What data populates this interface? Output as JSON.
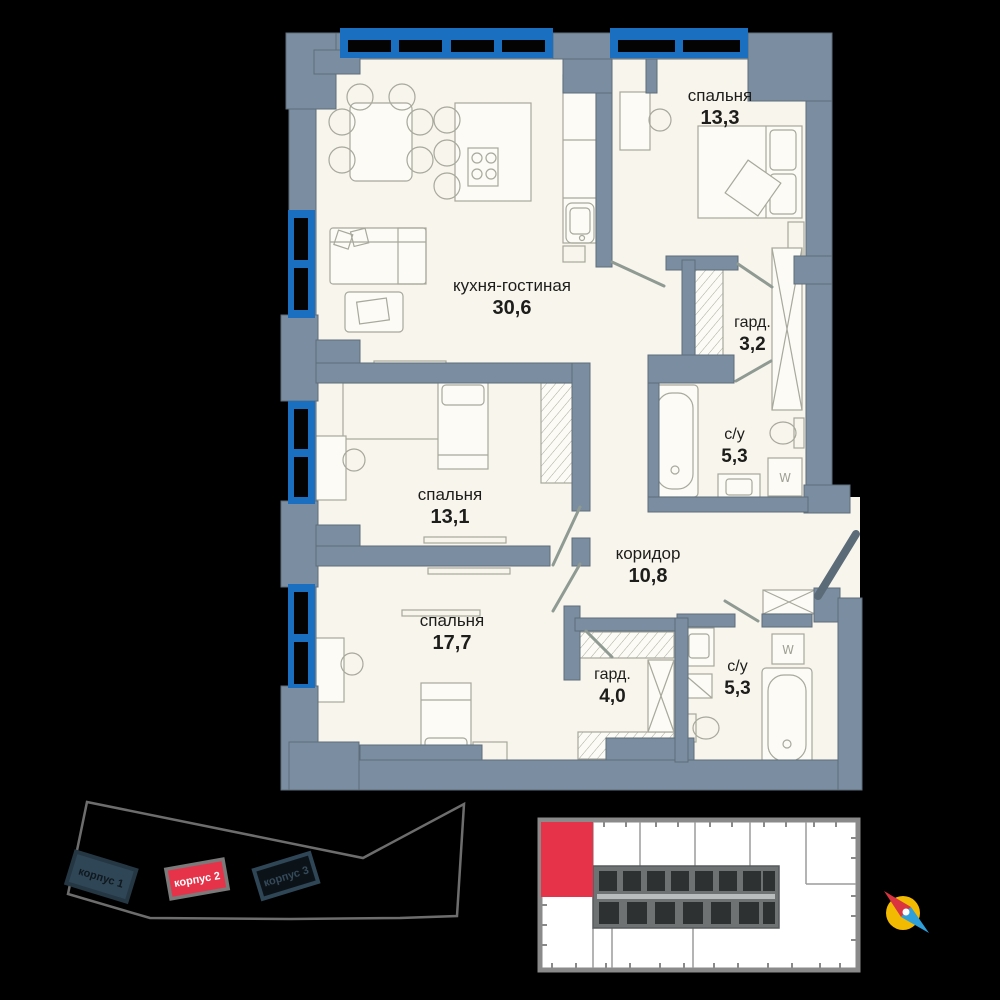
{
  "apartment_plan": {
    "rooms": [
      {
        "name": "спальня",
        "area": "13,3"
      },
      {
        "name": "кухня-гостиная",
        "area": "30,6"
      },
      {
        "name": "гард.",
        "area": "3,2"
      },
      {
        "name": "с/у",
        "area": "5,3"
      },
      {
        "name": "спальня",
        "area": "13,1"
      },
      {
        "name": "коридор",
        "area": "10,8"
      },
      {
        "name": "спальня",
        "area": "17,7"
      },
      {
        "name": "гард.",
        "area": "4,0"
      },
      {
        "name": "с/у",
        "area": "5,3"
      }
    ],
    "washer_label": "W"
  },
  "site_plan": {
    "buildings": [
      {
        "label": "корпус 1",
        "highlighted": false
      },
      {
        "label": "корпус 2",
        "highlighted": true
      },
      {
        "label": "корпус 3",
        "highlighted": false
      }
    ]
  },
  "colors": {
    "wall": "#7b8da0",
    "window_blue": "#1a6fc1",
    "floor": "#f8f5ec",
    "accent_red": "#e6334a",
    "compass_yellow": "#f2ba00",
    "compass_blue": "#2e9fd8"
  }
}
